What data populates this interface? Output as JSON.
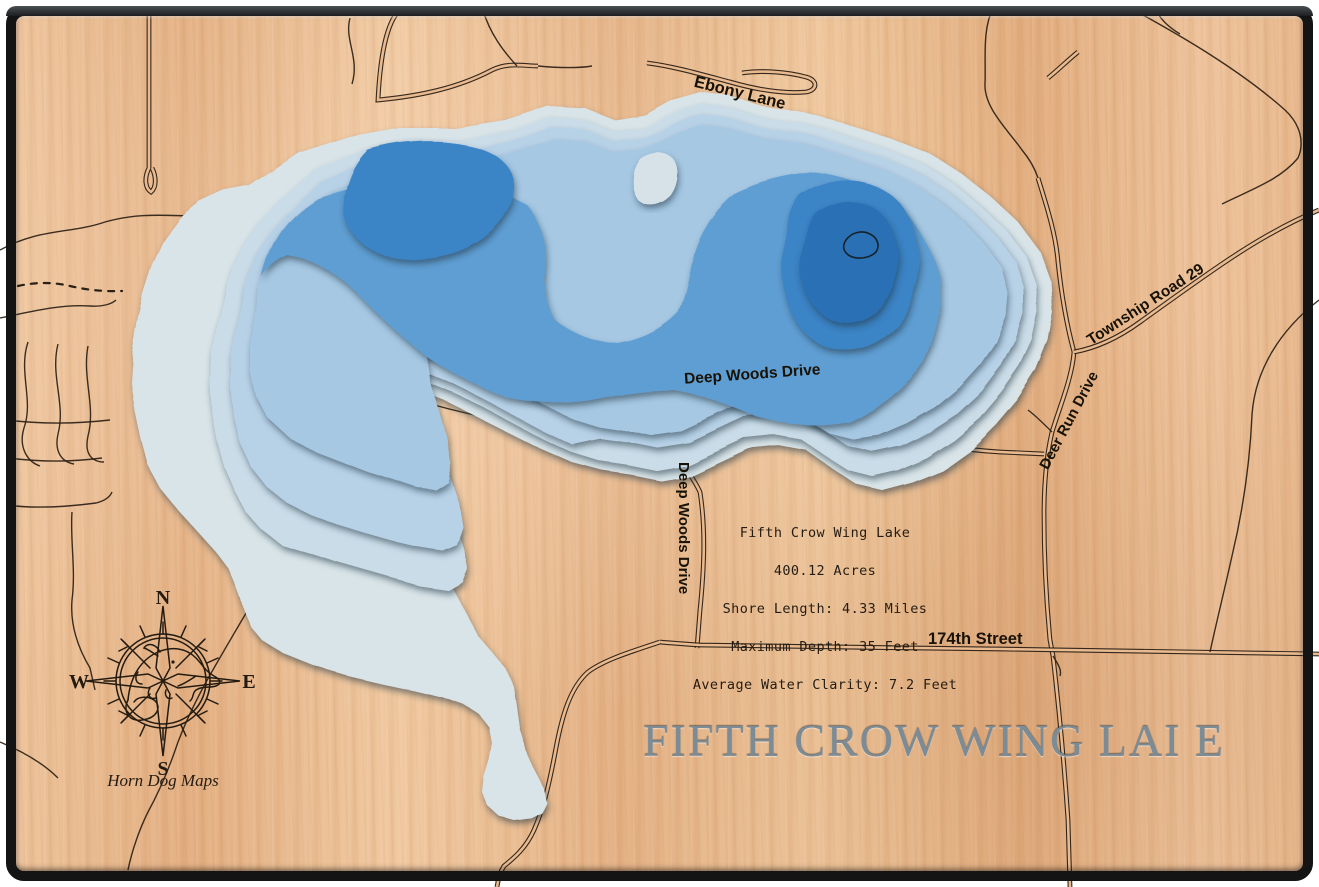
{
  "map": {
    "title": "FIFTH CROW WING LAI E",
    "info_box": {
      "lake_name": "Fifth Crow Wing Lake",
      "acres": "400.12 Acres",
      "shore_length": "Shore Length: 4.33 Miles",
      "max_depth": "Maximum Depth: 35 Feet",
      "clarity": "Average Water Clarity: 7.2 Feet"
    },
    "roads": {
      "ebony_lane": "Ebony Lane",
      "deep_woods_drive_h": "Deep Woods Drive",
      "deep_woods_drive_v": "Deep Woods Drive",
      "deer_run_drive": "Deer Run Drive",
      "township_road": "Township Road 29",
      "street_174": "174th Street"
    },
    "compass": {
      "north": "N",
      "east": "E",
      "south": "S",
      "west": "W",
      "credit": "Horn Dog Maps"
    },
    "colors": {
      "wood": "#e9ba8f",
      "frame": "#141414",
      "title_text": "#7c8c96",
      "road_line": "#2b2015",
      "depth": [
        "#d8e4e8",
        "#cadce8",
        "#b7d1e7",
        "#a6c8e3",
        "#5f9ed3",
        "#3b84c6",
        "#2b6fb4"
      ],
      "island": "#d6e2e8",
      "deepest_contour_line": "#16222b"
    }
  }
}
